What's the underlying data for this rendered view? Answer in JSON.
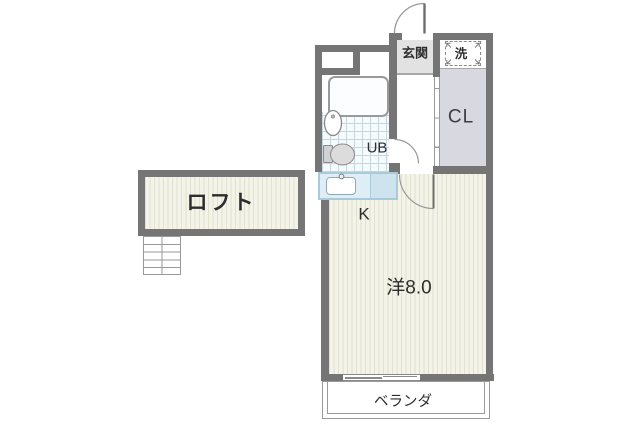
{
  "plan": {
    "rooms": {
      "loft": {
        "label": "ロフト"
      },
      "entrance": {
        "label": "玄関"
      },
      "laundry": {
        "label": "洗"
      },
      "closet": {
        "label": "CL"
      },
      "unit_bath": {
        "label": "UB"
      },
      "kitchen": {
        "label": "K"
      },
      "western_room": {
        "label": "洋8.0"
      },
      "veranda": {
        "label": "ベランダ"
      }
    },
    "colors": {
      "wall": "#757575",
      "floor": "#f4f3e8",
      "floor_stripe": "#e1e0d1",
      "closet_fill": "#d8d8e1",
      "entrance_fill": "#e2e2e2",
      "counter_fill": "#dfeef6",
      "counter_fill_right": "#cfe3ee",
      "counter_border": "#a8cbda",
      "tile_line": "#c6d6de",
      "line": "#8a8a8a",
      "background": "#ffffff"
    }
  }
}
